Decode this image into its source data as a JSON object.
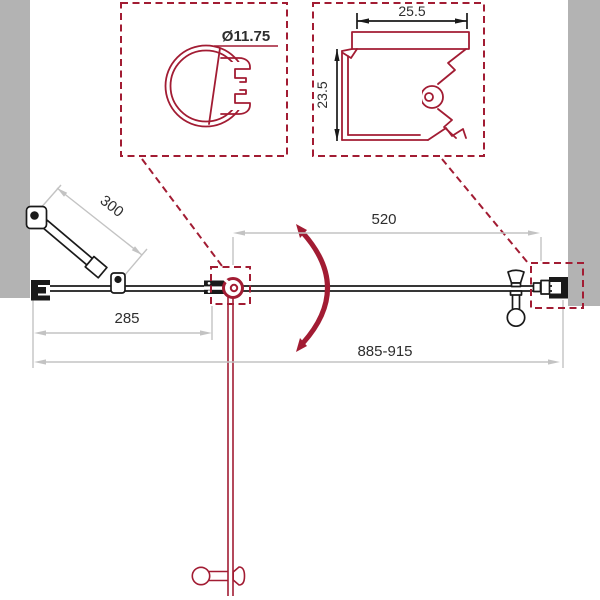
{
  "drawing": {
    "detail_pivot": {
      "diameter_label": "Ø11.75"
    },
    "detail_wall_profile": {
      "width_label": "25.5",
      "height_label": "23.5"
    },
    "dims": {
      "support_bar": "300",
      "fixed_panel": "285",
      "door": "520",
      "overall": "885-915"
    }
  },
  "colors": {
    "accent_red": "#A21C33",
    "wall_gray": "#B3B3B3",
    "dim_gray": "#C3C3C3",
    "ink_black": "#1A1A1A",
    "text_dark": "#2E2E2E",
    "background": "#FFFFFF"
  }
}
